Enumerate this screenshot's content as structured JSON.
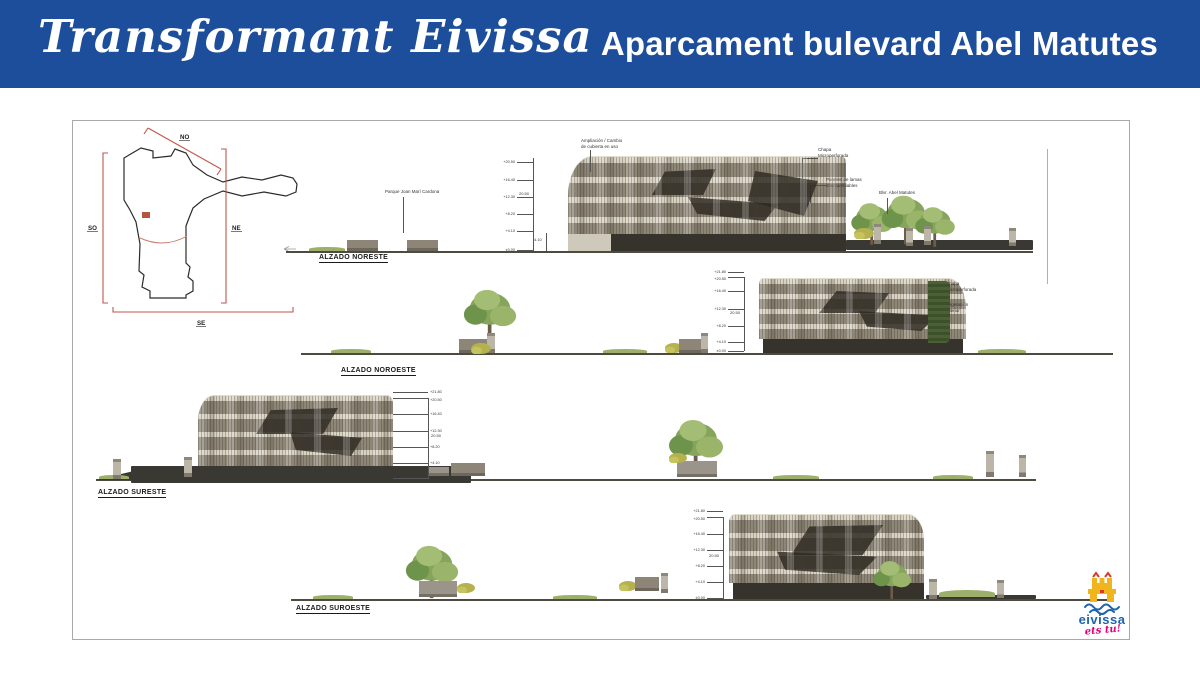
{
  "header": {
    "brand": "Transformant Eivissa",
    "title": "Aparcament bulevard Abel Matutes"
  },
  "site_plan": {
    "label_no": "NO",
    "label_so": "SO",
    "label_ne": "NE",
    "label_se": "SE"
  },
  "elevations": {
    "noreste": {
      "label": "ALZADO NORESTE",
      "levels": [
        "+20.50",
        "+16.40",
        "+12.30",
        "+8.20",
        "+4.10",
        "±0.00"
      ],
      "dim_total": "20.50",
      "dim_ground": "4.10",
      "ann_park": "Parque Joan Marí Cardona",
      "ann_roof_line1": "Ampliación / Cambio",
      "ann_roof_line2": "de cubierta en uso",
      "ann_chapa_line1": "Chapa",
      "ann_chapa_line2": "Microperforada",
      "ann_lamas_line1": "Paneles de lamas",
      "ann_lamas_line2": "intercambiables",
      "ann_boulevard": "Blvr. Abel Matutes"
    },
    "noroeste": {
      "label": "ALZADO NOROESTE",
      "levels": [
        "+21.80",
        "+20.50",
        "+16.40",
        "+12.30",
        "+8.20",
        "+4.10",
        "±0.00"
      ],
      "dim_total": "20.50",
      "ann_chapa_line1": "Chapa",
      "ann_chapa_line2": "Microperforada",
      "ann_veg_line1": "Vegetación",
      "ann_veg_line2": "interior"
    },
    "sureste": {
      "label": "ALZADO SURESTE",
      "levels": [
        "+21.80",
        "+20.50",
        "+16.40",
        "+12.30",
        "+8.20",
        "+4.10",
        "±0.00"
      ],
      "dim_total": "20.50"
    },
    "suroeste": {
      "label": "ALZADO SUROESTE",
      "levels": [
        "+21.80",
        "+20.50",
        "+16.40",
        "+12.30",
        "+8.20",
        "+4.10",
        "±0.00"
      ],
      "dim_total": "20.50"
    }
  },
  "logo": {
    "name": "eivissa",
    "tagline": "ets tu!"
  },
  "colors": {
    "header_bg": "#1d4e9b",
    "facade_light": "#d8d2c3",
    "facade_dark": "#8e8676",
    "base_dark": "#35332c",
    "ground": "#4d4a42",
    "plan_red": "#c0564a",
    "tree_green": "#86a55c",
    "logo_blue": "#1f63ad",
    "logo_yellow": "#f0b41d",
    "logo_pink": "#e5007d"
  }
}
